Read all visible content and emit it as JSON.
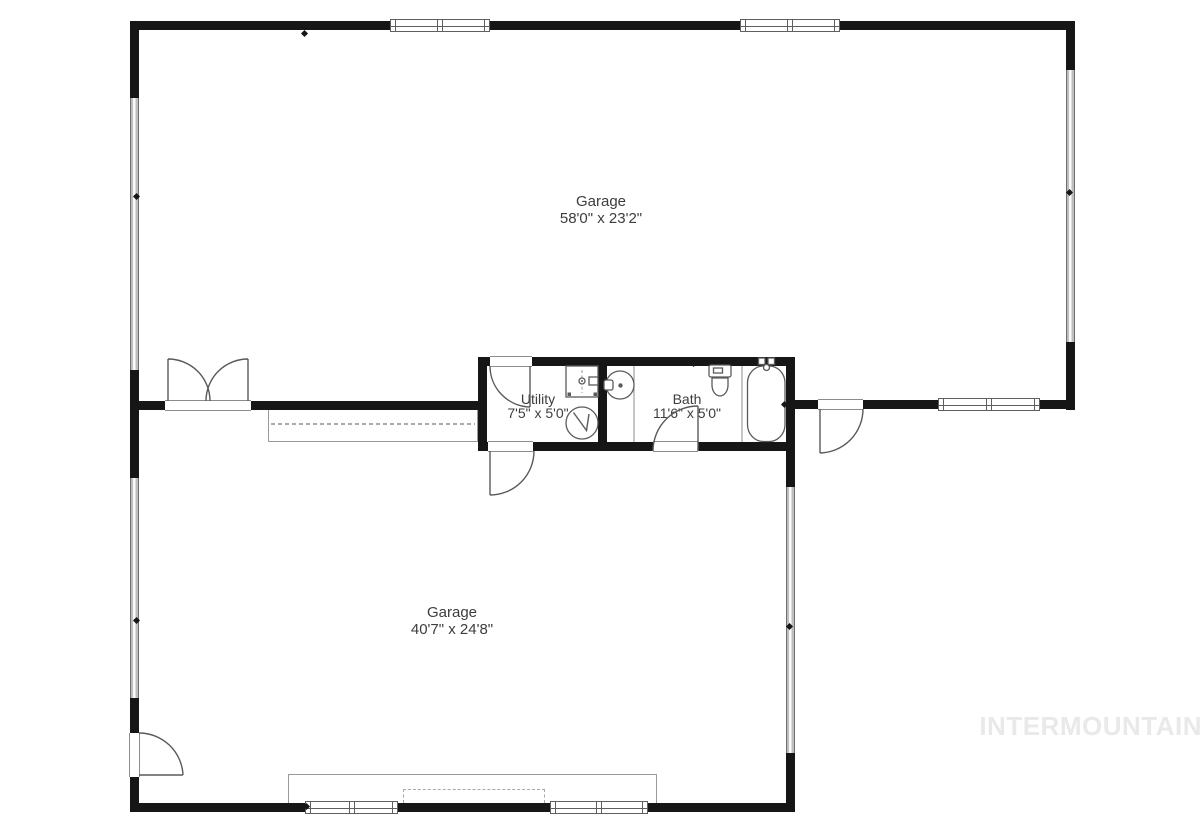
{
  "watermark": "INTERMOUNTAIN",
  "rooms": {
    "garage_top": {
      "name": "Garage",
      "dimensions": "58'0\" x 23'2\""
    },
    "garage_bottom": {
      "name": "Garage",
      "dimensions": "40'7\" x 24'8\""
    },
    "utility": {
      "name": "Utility",
      "dimensions": "7'5\" x 5'0\""
    },
    "bath": {
      "name": "Bath",
      "dimensions": "11'6\" x 5'0\""
    }
  },
  "fixtures": [
    "toilet",
    "bathtub",
    "round-sink",
    "laundry-sink",
    "water-heater"
  ],
  "colors": {
    "wall": "#161616",
    "line": "#5a5a5a",
    "thin": "#8c8c8c",
    "label": "#3d3d3d",
    "watermark": "#e9e9e9",
    "gdoor": "#bdbdbd",
    "bg": "#ffffff"
  }
}
